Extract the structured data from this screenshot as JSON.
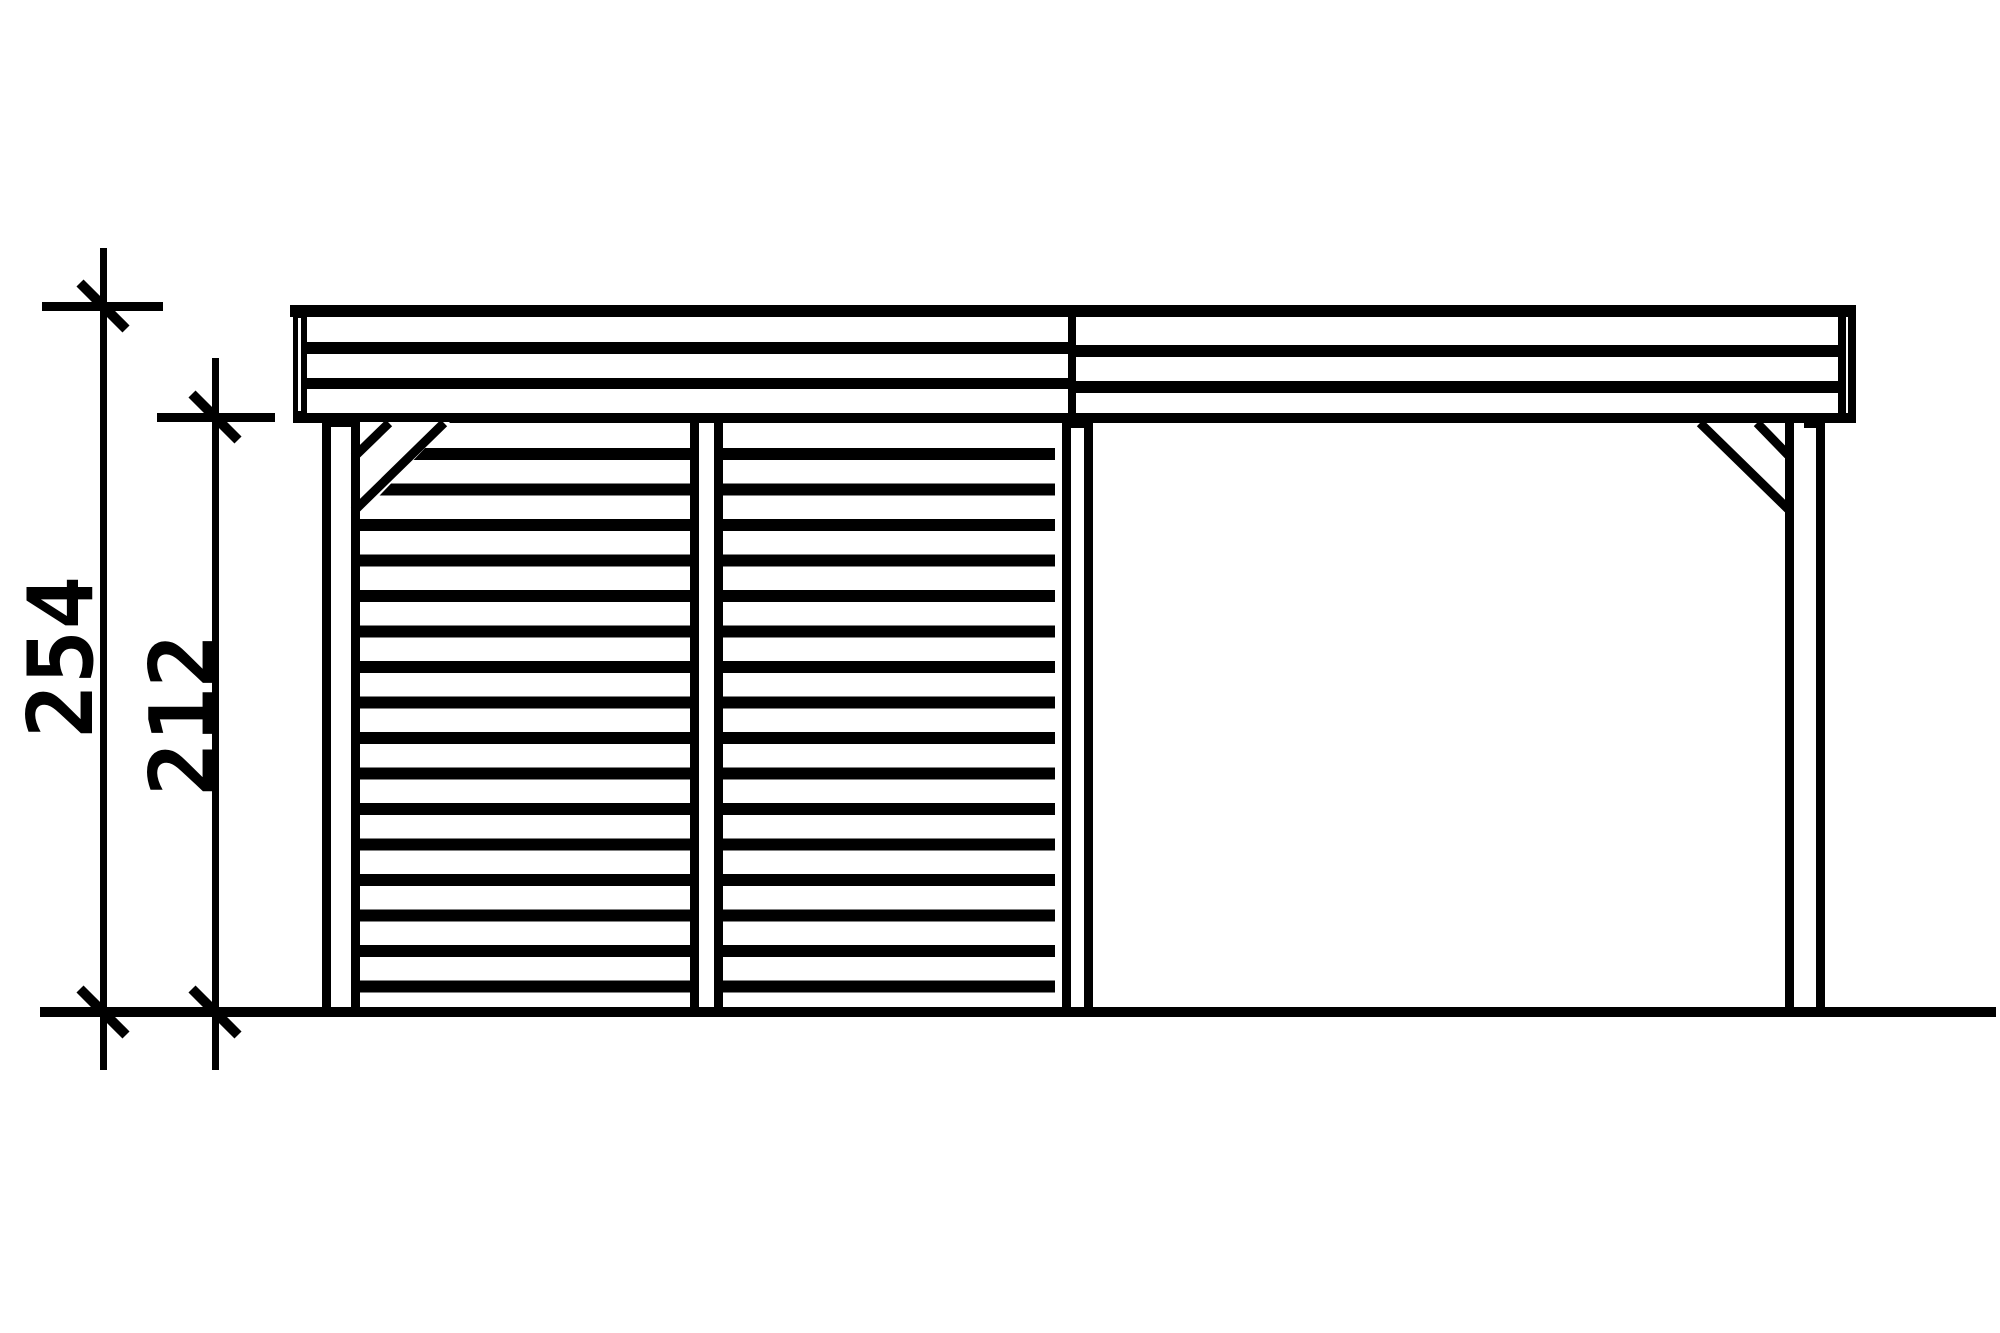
{
  "page": {
    "background_color": "#ffffff",
    "ink_color": "#000000"
  },
  "diagram": {
    "type": "technical-elevation-drawing",
    "subject": "Carport side elevation with closed slat walls and open bay",
    "dimensions": [
      {
        "label": "254",
        "meaning": "overall height to roof top",
        "orientation": "vertical"
      },
      {
        "label": "212",
        "meaning": "clearance height to roof underside",
        "orientation": "vertical"
      }
    ],
    "components": [
      "flat-roof-fascia",
      "roof-section-divider",
      "left-post",
      "middle-post",
      "right-post",
      "slat-wall-panel-1",
      "slat-wall-panel-2",
      "corner-brace-left",
      "corner-brace-right",
      "ground-line",
      "dimension-line-254",
      "dimension-line-212"
    ]
  }
}
